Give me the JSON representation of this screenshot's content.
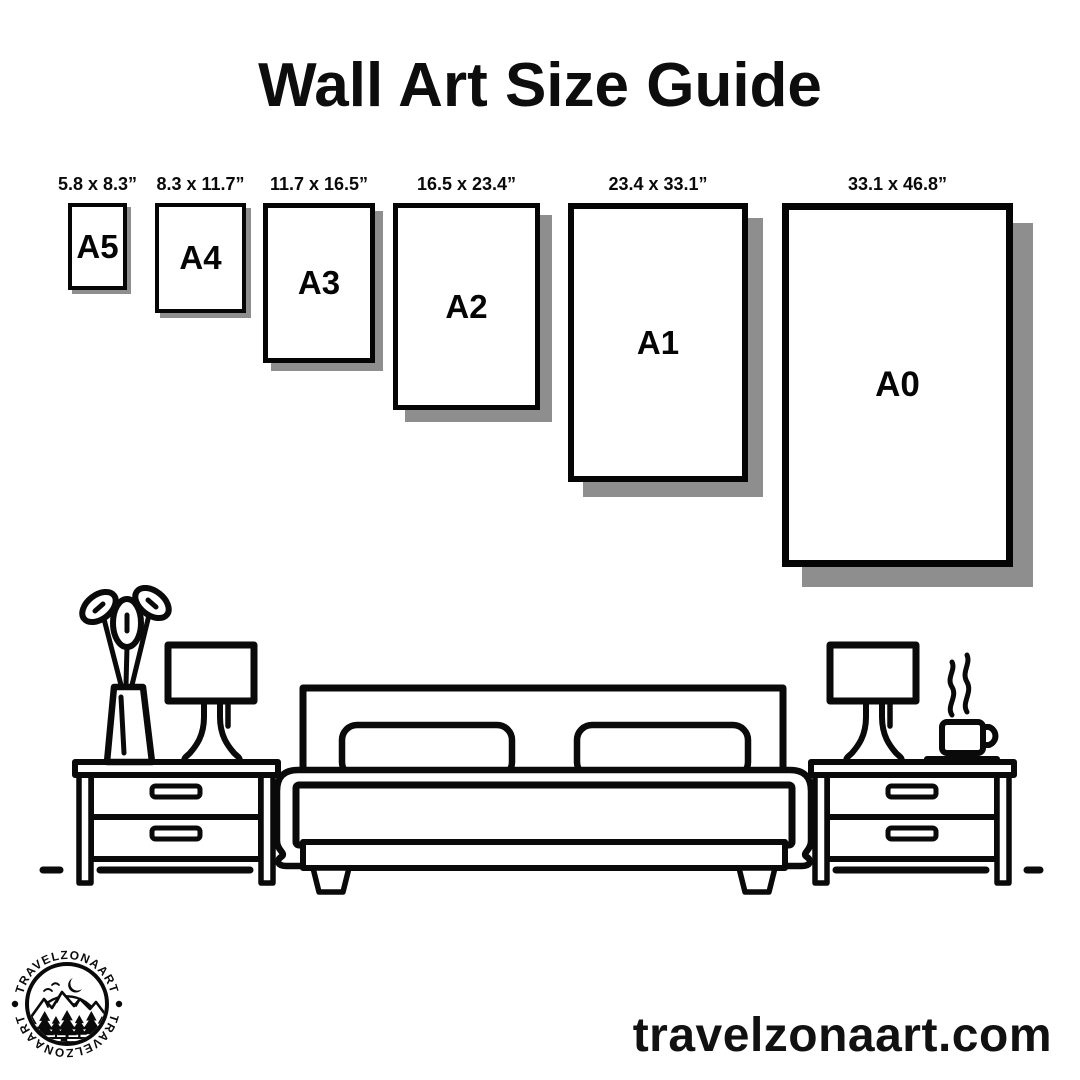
{
  "header": {
    "title": "Wall Art Size Guide"
  },
  "sizes": [
    {
      "code": "A5",
      "dims": "5.8 x 8.3”"
    },
    {
      "code": "A4",
      "dims": "8.3 x 11.7”"
    },
    {
      "code": "A3",
      "dims": "11.7 x 16.5”"
    },
    {
      "code": "A2",
      "dims": "16.5 x 23.4”"
    },
    {
      "code": "A1",
      "dims": "23.4 x 33.1”"
    },
    {
      "code": "A0",
      "dims": "33.1 x 46.8”"
    }
  ],
  "logo": {
    "arc_text_top": "TRAVELZONAART",
    "arc_text_bottom": "TRAVELZONAART"
  },
  "footer": {
    "website": "travelzonaart.com"
  },
  "colors": {
    "ink": "#0a0a0a",
    "paper_shadow": "#8e8e8e",
    "background": "#ffffff"
  },
  "icons": {
    "scene": "bedroom-line-art",
    "logo_scene": "mountains-forest-moon-badge"
  }
}
